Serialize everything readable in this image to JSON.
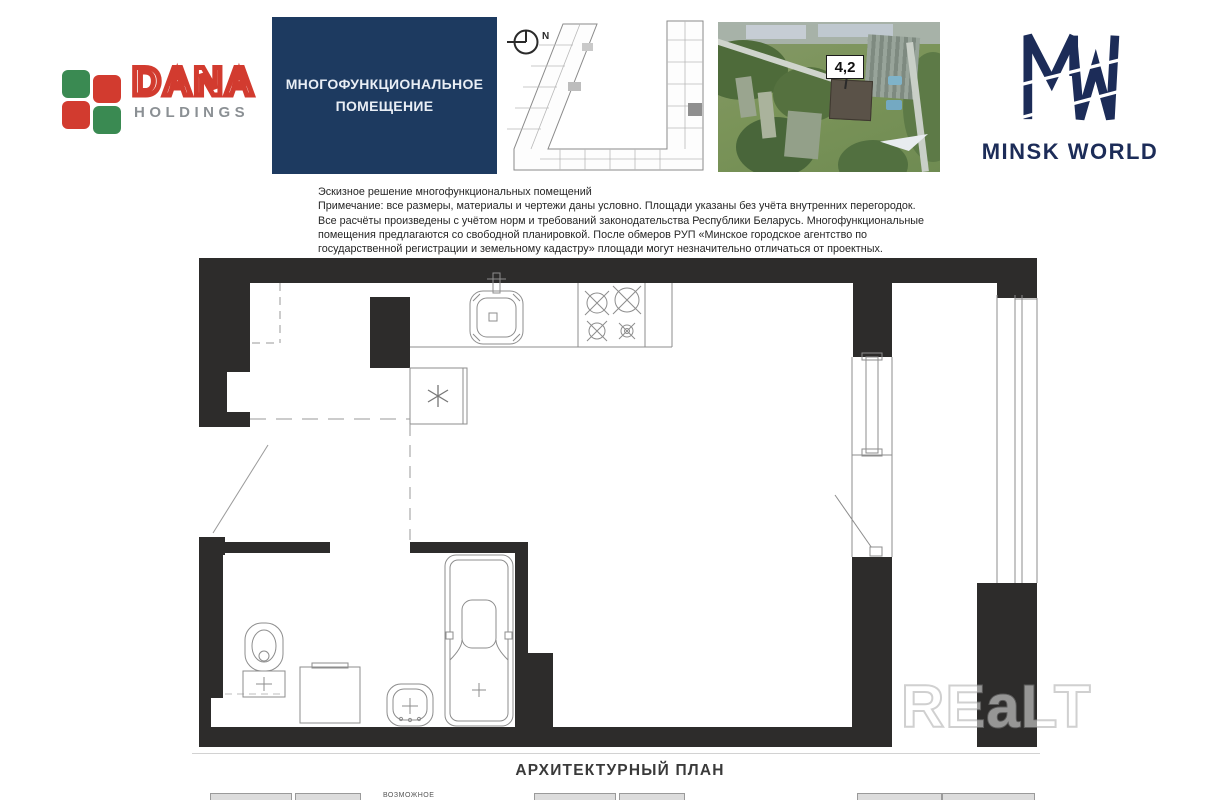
{
  "header": {
    "dana_logo": {
      "brand": "DANA",
      "subtitle": "HOLDINGS",
      "green": "#3a8a52",
      "red": "#d23b2f"
    },
    "unit_type_box": {
      "line1": "МНОГОФУНКЦИОНАЛЬНОЕ",
      "line2": "ПОМЕЩЕНИЕ",
      "bg": "#1d3a60"
    },
    "key_plan": {
      "north_label": "N"
    },
    "aerial_photo": {
      "building_badge": "4,2"
    },
    "brand_logo": {
      "name": "MINSK WORLD",
      "navy": "#1c2c58"
    }
  },
  "disclaimer": {
    "lines": [
      "Эскизное решение многофункциональных помещений",
      "Примечание: все размеры, материалы и чертежи даны условно. Площади указаны без учёта внутренних перегородок.",
      "Все расчёты произведены с учётом норм и требований законодательства Республики Беларусь. Многофункциональные",
      "помещения предлагаются со свободной планировкой. После обмеров РУП «Минское городское агентство по",
      "государственной регистрации и земельному кадастру» площади могут незначительно отличаться от проектных."
    ]
  },
  "floor_plan": {
    "caption": "АРХИТЕКТУРНЫЙ ПЛАН",
    "wall_color": "#2d2c2b",
    "fixtures": [
      "kitchen-sink",
      "stove",
      "ventilation-shaft",
      "appliance-spot",
      "toilet",
      "washing-machine",
      "wash-basin",
      "bathtub",
      "balcony-window",
      "balcony-door",
      "entry-door"
    ]
  },
  "watermark": {
    "text": "REaLT"
  },
  "legend": {
    "note": "ВОЗМОЖНОЕ"
  }
}
